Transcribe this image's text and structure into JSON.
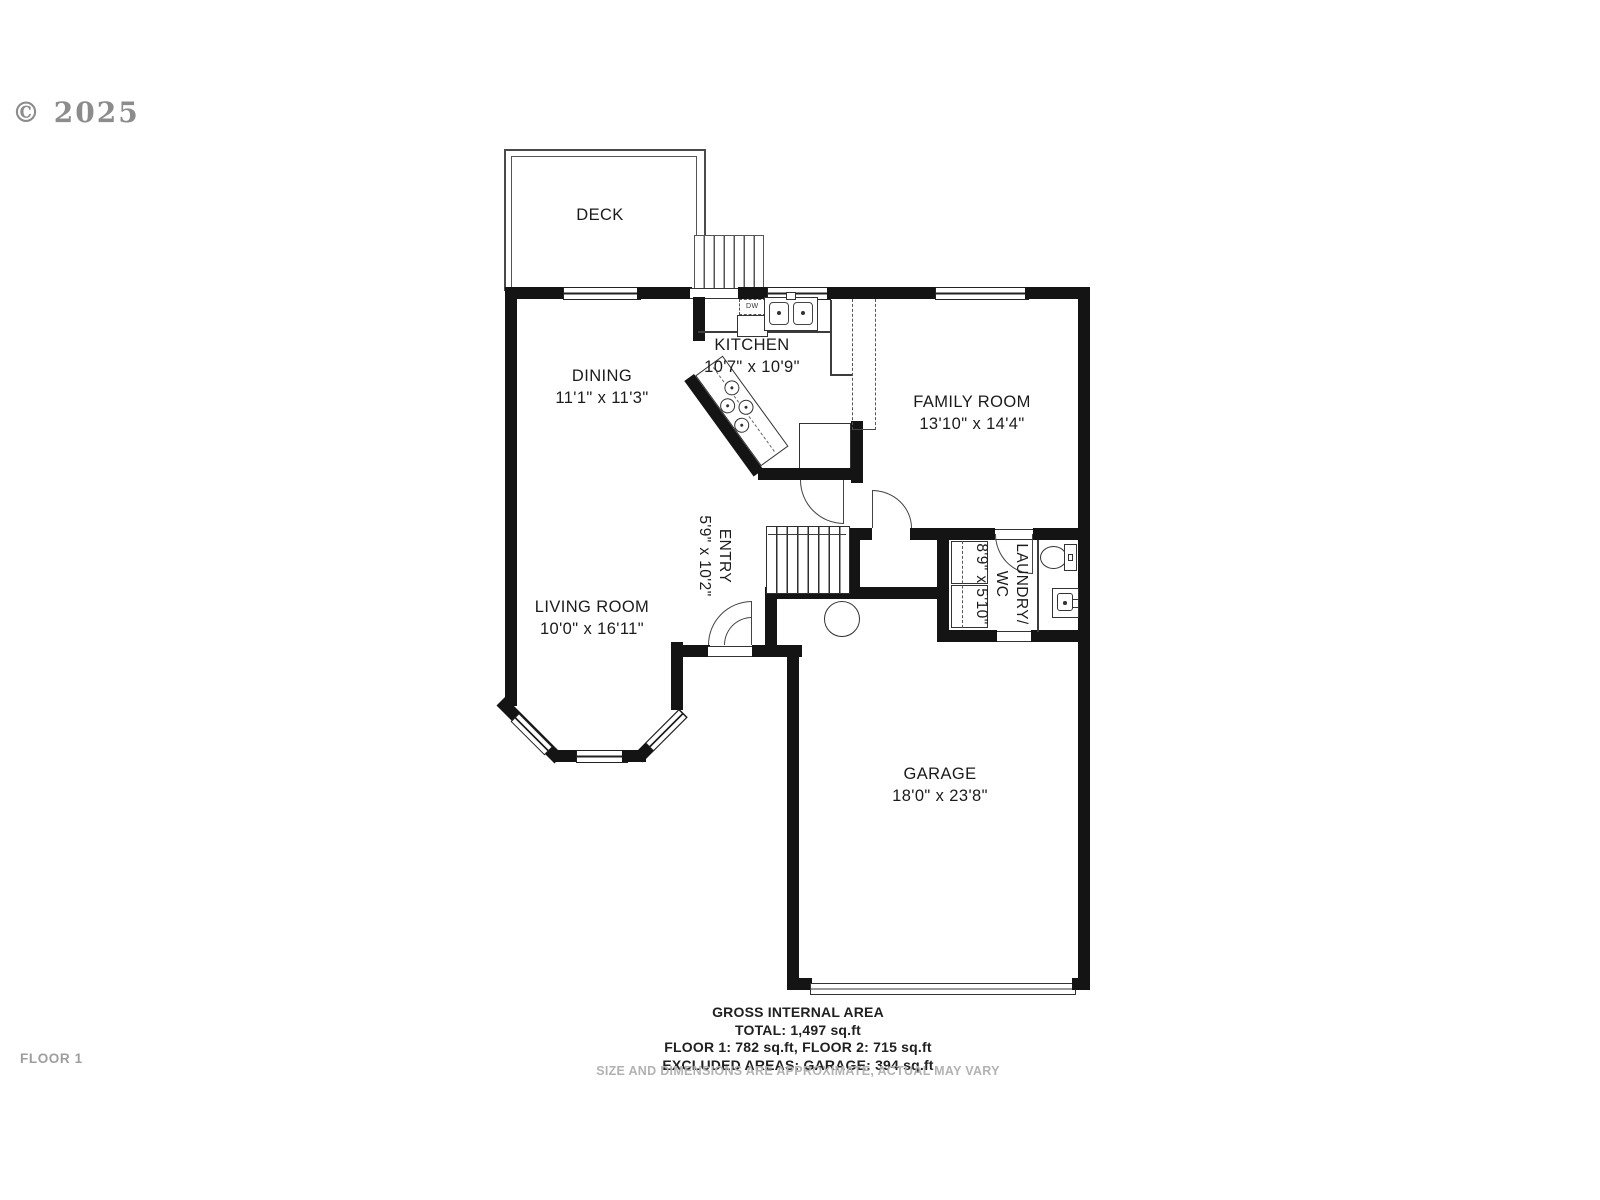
{
  "watermark": {
    "copyright": "© 2025"
  },
  "rooms": {
    "deck": {
      "name": "DECK"
    },
    "dining": {
      "name": "DINING",
      "dims": "11'1\" x 11'3\""
    },
    "kitchen": {
      "name": "KITCHEN",
      "dims": "10'7\" x 10'9\""
    },
    "family_room": {
      "name": "FAMILY ROOM",
      "dims": "13'10\" x 14'4\""
    },
    "entry": {
      "name": "ENTRY",
      "dims": "5'9\" x 10'2\""
    },
    "living_room": {
      "name": "LIVING ROOM",
      "dims": "10'0\" x 16'11\""
    },
    "laundry_wc": {
      "name": "LAUNDRY/",
      "name2": "WC",
      "dims": "8'9\" x 5'10\""
    },
    "garage": {
      "name": "GARAGE",
      "dims": "18'0\" x 23'8\""
    }
  },
  "appliances": {
    "dishwasher": "DW"
  },
  "summary": {
    "title": "GROSS INTERNAL AREA",
    "total": "TOTAL: 1,497 sq.ft",
    "floors": "FLOOR 1: 782 sq.ft, FLOOR 2: 715 sq.ft",
    "excluded": "EXCLUDED AREAS: GARAGE: 394 sq.ft"
  },
  "footer": {
    "floor_label": "FLOOR 1",
    "disclaimer": "SIZE AND DIMENSIONS ARE APPROXIMATE, ACTUAL MAY VARY"
  },
  "colors": {
    "wall": "#141414",
    "line": "#3c3c3c",
    "muted": "#a9a9a9"
  }
}
